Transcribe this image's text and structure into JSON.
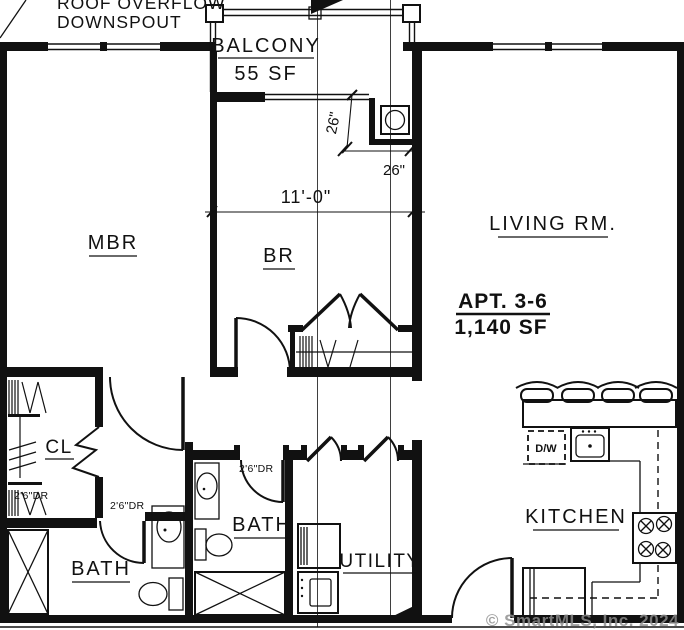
{
  "plan": {
    "apartment": {
      "name": "APT. 3-6",
      "area": "1,140 SF"
    },
    "rooms": {
      "balcony": {
        "label": "BALCONY",
        "area": "55 SF"
      },
      "mbr": {
        "label": "MBR"
      },
      "br": {
        "label": "BR"
      },
      "living": {
        "label": "LIVING RM."
      },
      "closet": {
        "label": "CL"
      },
      "bath_main": {
        "label": "BATH"
      },
      "bath_second": {
        "label": "BATH"
      },
      "utility": {
        "label": "UTILITY"
      },
      "kitchen": {
        "label": "KITCHEN"
      }
    },
    "appliances": {
      "dishwasher": "D/W"
    },
    "dimensions": {
      "bedroom_width": "11'-0\"",
      "chase_width": "26\"",
      "chase_depth": "26\"",
      "closet_door": "2'6\"DR",
      "bath_main_door": "2'6\"DR",
      "bath_second_door": "2'6\"DR"
    },
    "notes": {
      "roof_line1": "ROOF OVERFLOW",
      "roof_line2": "DOWNSPOUT"
    },
    "watermark": "© SmartMLS, Inc. 2024",
    "colors": {
      "line": "#111111",
      "section_line": "#3f3f3f",
      "watermark": "#8d8d8d",
      "background": "#ffffff"
    }
  }
}
